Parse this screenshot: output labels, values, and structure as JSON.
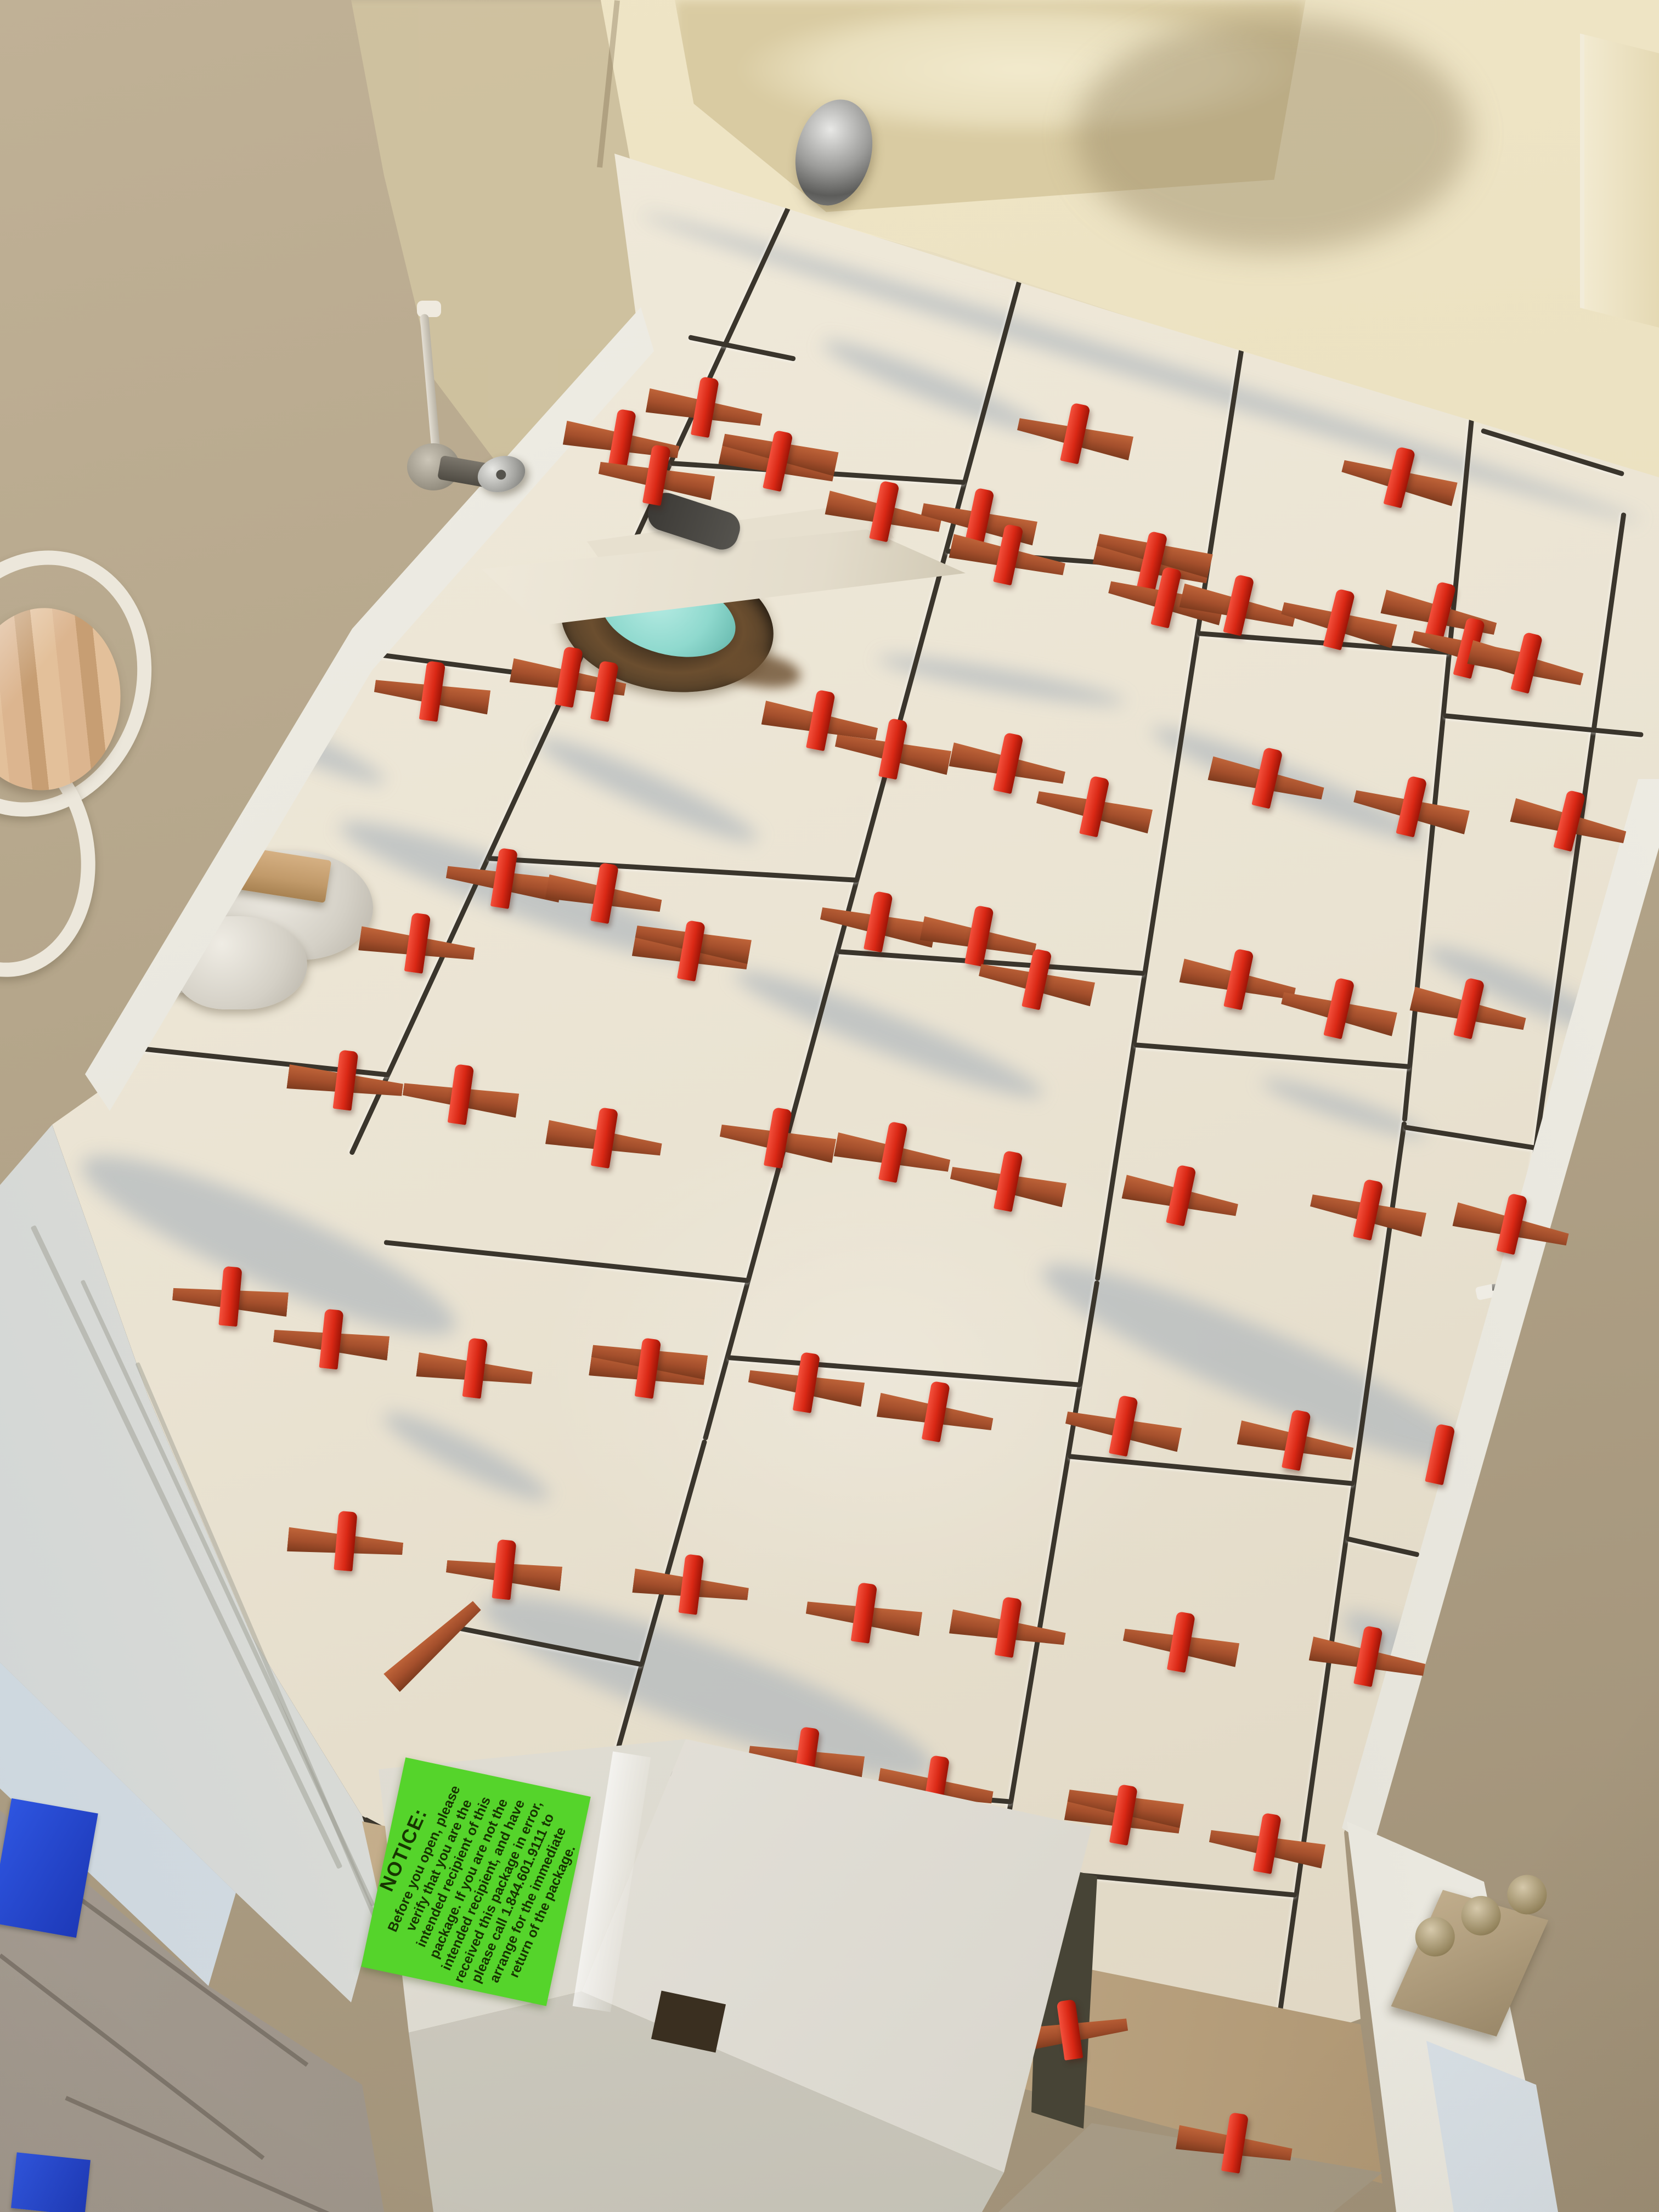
{
  "label": {
    "heading": "NOTICE:",
    "body": "Before you open, please verify that you are the intended recipient of this package. If you are not the intended recipient, and have received this package in error, please call 1.844.601.9111 to arrange for the immediate return of the package.",
    "phone": "1.844.601.9111",
    "background_color": "#55d42b",
    "text_color": "#173501"
  },
  "palette": {
    "wall": "#b3a489",
    "wall_patch": "#d2c5a2",
    "bathtub": "#e9dfbd",
    "tile": "#ece6d6",
    "marble_vein": "#aab3bb",
    "grout": "#3a352c",
    "leveling_clip_red": "#d92815",
    "leveling_wedge_terracotta": "#a44f2c",
    "drain_plug_teal": "#8fd9ce",
    "baseboard_white": "#f0eee6",
    "hall_wood_gray": "#9e958a",
    "threshold_wood_tan": "#bda684",
    "blue_tape": "#2e55e0",
    "box_cardboard": "#e4e1d9",
    "hinge_brass": "#9c8a6b"
  },
  "geometry": {
    "grout": [
      [
        1455,
        335,
        640,
        2100
      ],
      [
        1875,
        445,
        1285,
        2620
      ],
      [
        1285,
        2620,
        1060,
        3420
      ],
      [
        2275,
        555,
        2000,
        2330
      ],
      [
        2000,
        2330,
        1740,
        3900
      ],
      [
        2690,
        680,
        2560,
        2040
      ],
      [
        2560,
        2040,
        2300,
        3900
      ],
      [
        2960,
        930,
        2770,
        2300
      ],
      [
        660,
        1185,
        1045,
        1235
      ],
      [
        190,
        1900,
        710,
        1955
      ],
      [
        1222,
        840,
        1760,
        875
      ],
      [
        889,
        1560,
        1565,
        1600
      ],
      [
        700,
        2260,
        1366,
        2330
      ],
      [
        820,
        2960,
        1172,
        3030
      ],
      [
        1724,
        1000,
        2201,
        1035
      ],
      [
        1526,
        1730,
        2087,
        1770
      ],
      [
        1326,
        2470,
        1971,
        2520
      ],
      [
        1116,
        3220,
        1846,
        3280
      ],
      [
        1800,
        3900,
        2280,
        3960
      ],
      [
        2183,
        1150,
        2642,
        1185
      ],
      [
        2067,
        1900,
        2571,
        1940
      ],
      [
        1947,
        2650,
        2469,
        2700
      ],
      [
        1823,
        3400,
        2364,
        3450
      ],
      [
        2631,
        1300,
        2995,
        1335
      ],
      [
        2559,
        2050,
        2812,
        2090
      ],
      [
        2454,
        2800,
        2587,
        2830
      ],
      [
        1255,
        610,
        1450,
        650
      ],
      [
        2700,
        780,
        2960,
        860
      ],
      [
        660,
        3310,
        1130,
        3560,
        26
      ],
      [
        1130,
        3560,
        2060,
        3830,
        26
      ]
    ],
    "veins": [
      [
        620,
        1460,
        1280,
        1700,
        90
      ],
      [
        150,
        2050,
        830,
        2350,
        140
      ],
      [
        880,
        2850,
        1700,
        3150,
        150
      ],
      [
        1900,
        2250,
        2700,
        2600,
        130
      ],
      [
        1340,
        1740,
        1900,
        1960,
        70
      ],
      [
        2100,
        1300,
        2600,
        1500,
        60
      ],
      [
        2450,
        2900,
        2900,
        3150,
        90
      ],
      [
        1500,
        600,
        1900,
        760,
        50
      ],
      [
        2600,
        1700,
        2950,
        1850,
        60
      ],
      [
        980,
        1320,
        1380,
        1500,
        60
      ],
      [
        1700,
        3600,
        2300,
        3800,
        90
      ],
      [
        360,
        1250,
        700,
        1400,
        50
      ],
      [
        1600,
        1180,
        2050,
        1260,
        40
      ],
      [
        2300,
        1950,
        2600,
        2050,
        40
      ],
      [
        700,
        2550,
        1000,
        2700,
        60
      ],
      [
        1150,
        3950,
        1700,
        4030,
        70
      ],
      [
        1170,
        370,
        2990,
        930,
        40
      ]
    ],
    "spacers": [
      [
        1134,
        801,
        10,
        "rc"
      ],
      [
        1197,
        866,
        10,
        "lc"
      ],
      [
        1418,
        840,
        12,
        "dc"
      ],
      [
        1612,
        932,
        12,
        "rc"
      ],
      [
        1785,
        945,
        12,
        "lc"
      ],
      [
        1838,
        1011,
        12,
        "rc"
      ],
      [
        2100,
        1024,
        13,
        "dc"
      ],
      [
        2126,
        1089,
        13,
        "lc"
      ],
      [
        2258,
        1103,
        13,
        "rc"
      ],
      [
        2441,
        1129,
        14,
        "lc"
      ],
      [
        2625,
        1116,
        14,
        "rc"
      ],
      [
        2678,
        1181,
        14,
        "lc"
      ],
      [
        2783,
        1208,
        14,
        "rc"
      ],
      [
        1037,
        1234,
        10,
        "rc"
      ],
      [
        788,
        1260,
        8,
        "lc"
      ],
      [
        1102,
        1260,
        10,
        "c"
      ],
      [
        1496,
        1313,
        11,
        "rc"
      ],
      [
        1628,
        1365,
        11,
        "lc"
      ],
      [
        1838,
        1391,
        12,
        "rc"
      ],
      [
        1995,
        1470,
        12,
        "lc"
      ],
      [
        2310,
        1418,
        13,
        "rc"
      ],
      [
        2573,
        1470,
        13,
        "lc"
      ],
      [
        2861,
        1496,
        14,
        "rc"
      ],
      [
        919,
        1601,
        9,
        "lc"
      ],
      [
        1102,
        1628,
        10,
        "rc"
      ],
      [
        761,
        1719,
        8,
        "rc"
      ],
      [
        1260,
        1733,
        10,
        "dc"
      ],
      [
        1601,
        1680,
        11,
        "lc"
      ],
      [
        1785,
        1706,
        11,
        "rc"
      ],
      [
        1890,
        1785,
        12,
        "lc"
      ],
      [
        2258,
        1785,
        12,
        "rc"
      ],
      [
        2441,
        1838,
        13,
        "lc"
      ],
      [
        2678,
        1838,
        13,
        "rc"
      ],
      [
        630,
        1969,
        7,
        "rc"
      ],
      [
        840,
        1995,
        8,
        "lc"
      ],
      [
        1102,
        2074,
        9,
        "rc"
      ],
      [
        1418,
        2074,
        10,
        "lc"
      ],
      [
        1628,
        2100,
        11,
        "rc"
      ],
      [
        1838,
        2153,
        11,
        "lc"
      ],
      [
        2153,
        2179,
        12,
        "rc"
      ],
      [
        2494,
        2205,
        12,
        "lc"
      ],
      [
        2756,
        2231,
        13,
        "rc"
      ],
      [
        420,
        2363,
        5,
        "lc"
      ],
      [
        604,
        2441,
        6,
        "lc"
      ],
      [
        866,
        2494,
        7,
        "rc"
      ],
      [
        1181,
        2494,
        8,
        "dc"
      ],
      [
        1470,
        2520,
        9,
        "lc"
      ],
      [
        1706,
        2573,
        10,
        "rc"
      ],
      [
        2048,
        2599,
        11,
        "lc"
      ],
      [
        2363,
        2625,
        11,
        "rc"
      ],
      [
        2625,
        2651,
        12,
        "c"
      ],
      [
        630,
        2809,
        5,
        "rc"
      ],
      [
        919,
        2861,
        6,
        "lc"
      ],
      [
        1260,
        2888,
        7,
        "rc"
      ],
      [
        1575,
        2940,
        8,
        "lc"
      ],
      [
        1838,
        2966,
        9,
        "rc"
      ],
      [
        2153,
        2993,
        10,
        "lc"
      ],
      [
        788,
        2993,
        -42,
        "w"
      ],
      [
        2494,
        3019,
        11,
        "rc"
      ],
      [
        1470,
        3203,
        8,
        "lc"
      ],
      [
        1706,
        3255,
        9,
        "rc"
      ],
      [
        2048,
        3308,
        10,
        "dc"
      ],
      [
        2310,
        3360,
        10,
        "lc"
      ],
      [
        1950,
        3700,
        -8,
        "rc"
      ],
      [
        2251,
        3906,
        9,
        "rc"
      ],
      [
        1285,
        742,
        10,
        "rc"
      ],
      [
        1960,
        790,
        12,
        "lc"
      ],
      [
        2551,
        870,
        14,
        "lc"
      ]
    ],
    "trim_lines": [
      [
        60,
        2230,
        620,
        3400,
        10
      ],
      [
        150,
        2330,
        680,
        3470,
        8
      ],
      [
        250,
        2480,
        700,
        3530,
        8
      ]
    ],
    "planks": [
      [
        40,
        3380,
        560,
        3760,
        8
      ],
      [
        0,
        3560,
        480,
        3930,
        8
      ],
      [
        120,
        3820,
        600,
        4032,
        8
      ],
      [
        2050,
        3940,
        2450,
        4010,
        7
      ]
    ]
  }
}
